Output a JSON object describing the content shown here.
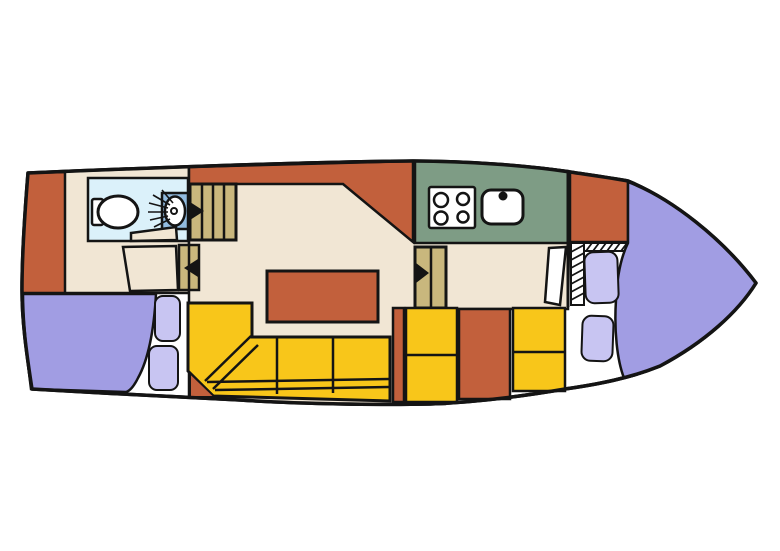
{
  "colors": {
    "background": "#FFFFFF",
    "line": "#141414",
    "hull_floor": "#FFFFFF",
    "deck_trim": "#C2603C",
    "cabin_floor": "#F1E6D4",
    "seating": "#F8C61A",
    "berth": "#A19DE3",
    "pillow": "#C8C5F2",
    "bathroom_floor": "#DBF1FA",
    "basin_counter": "#92BBDF",
    "galley_counter": "#7E9C85",
    "stairs": "#C9B77D",
    "fixture": "#FFFFFF",
    "arrow": "#141414"
  },
  "icons": [
    "toilet-icon",
    "washbasin-icon",
    "shower-spray-icon",
    "stove-icon",
    "sink-icon",
    "companionway-stairs-icon",
    "direction-arrow-icon",
    "hatch-steps-icon"
  ]
}
